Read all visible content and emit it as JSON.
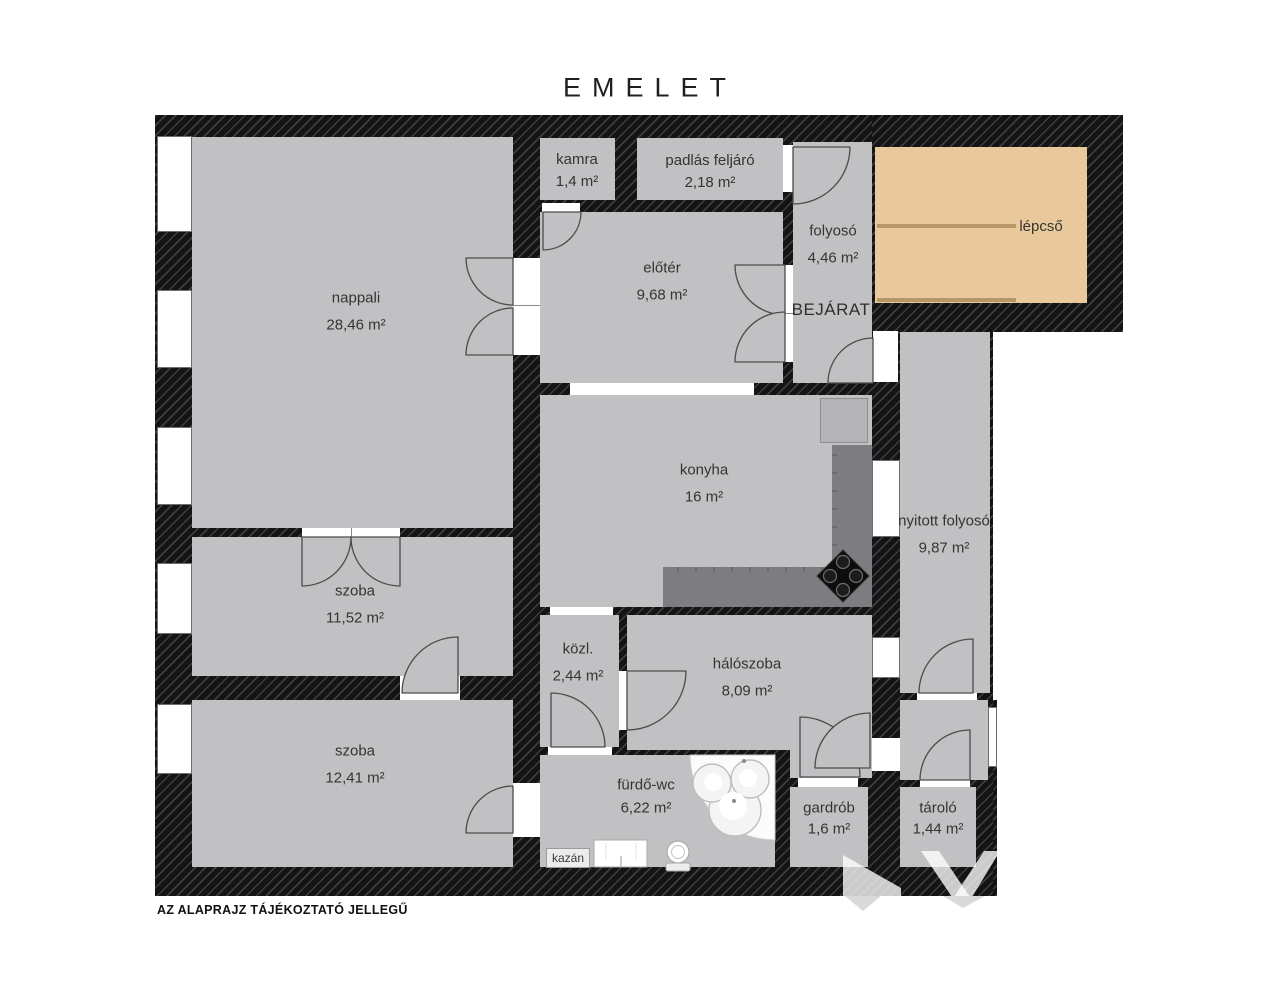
{
  "title": "EMELET",
  "footer": "AZ ALAPRAJZ TÁJÉKOZTATÓ JELLEGŰ",
  "entrance": "BEJÁRAT",
  "rooms": {
    "nappali": {
      "name": "nappali",
      "area": "28,46 m²"
    },
    "kamra": {
      "name": "kamra",
      "area": "1,4 m²"
    },
    "padlas_feljaro": {
      "name": "padlás feljáró",
      "area": "2,18 m²"
    },
    "eloter": {
      "name": "előtér",
      "area": "9,68 m²"
    },
    "folyoso": {
      "name": "folyosó",
      "area": "4,46 m²"
    },
    "lepcso": {
      "name": "lépcső",
      "area": ""
    },
    "konyha": {
      "name": "konyha",
      "area": "16 m²"
    },
    "nyitott_folyoso": {
      "name": "nyitott folyosó",
      "area": "9,87 m²"
    },
    "szoba_1": {
      "name": "szoba",
      "area": "11,52 m²"
    },
    "szoba_2": {
      "name": "szoba",
      "area": "12,41 m²"
    },
    "kozl": {
      "name": "közl.",
      "area": "2,44 m²"
    },
    "haloszoba": {
      "name": "hálószoba",
      "area": "8,09 m²"
    },
    "furdo_wc": {
      "name": "fürdő-wc",
      "area": "6,22 m²"
    },
    "gardrob": {
      "name": "gardrób",
      "area": "1,6 m²"
    },
    "tarolo": {
      "name": "tároló",
      "area": "1,44 m²"
    }
  },
  "fixtures": {
    "boiler": "kazán"
  },
  "colors": {
    "wall": "#141414",
    "floor": "#c1c1c3",
    "stairs": "#e9c99b",
    "stairs_line": "#b79769",
    "counter": "#7d7d81",
    "stove": "#0d0d0d"
  }
}
